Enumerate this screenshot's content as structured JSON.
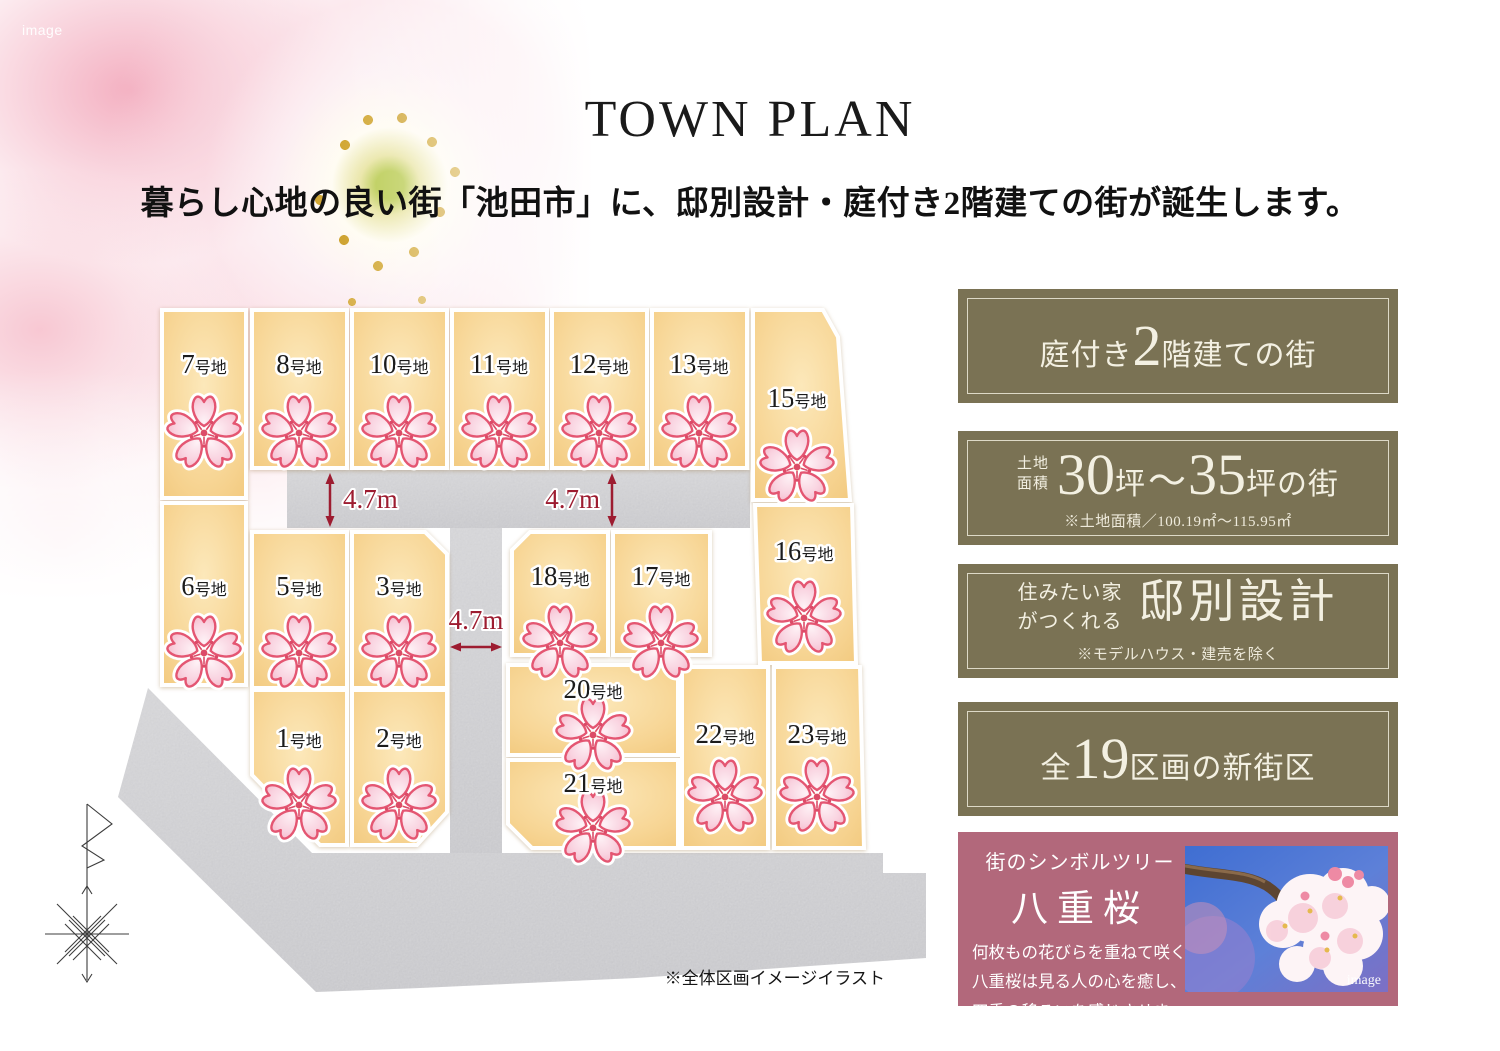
{
  "hero": {
    "image_label": "image"
  },
  "header": {
    "title": "TOWN PLAN",
    "subtitle": "暮らし心地の良い街「池田市」に、邸別設計・庭付き2階建ての街が誕生します。"
  },
  "map": {
    "note": "※全体区画イメージイラスト",
    "lot_suffix": "号地",
    "road_labels": [
      "4.7m",
      "4.7m",
      "4.7m"
    ],
    "lots": [
      {
        "number": "7"
      },
      {
        "number": "8"
      },
      {
        "number": "10"
      },
      {
        "number": "11"
      },
      {
        "number": "12"
      },
      {
        "number": "13"
      },
      {
        "number": "15"
      },
      {
        "number": "6"
      },
      {
        "number": "5"
      },
      {
        "number": "3"
      },
      {
        "number": "18"
      },
      {
        "number": "17"
      },
      {
        "number": "16"
      },
      {
        "number": "1"
      },
      {
        "number": "2"
      },
      {
        "number": "20"
      },
      {
        "number": "21"
      },
      {
        "number": "22"
      },
      {
        "number": "23"
      }
    ]
  },
  "panels": {
    "two_story": {
      "pre": "庭付き",
      "big": "2",
      "post": "階建ての街"
    },
    "land_area": {
      "stack_top": "土地",
      "stack_bottom": "面積",
      "big1": "30",
      "unit1": "坪",
      "tilde": "〜",
      "big2": "35",
      "unit2": "坪の街",
      "note": "※土地面積／100.19㎡〜115.95㎡"
    },
    "custom_design": {
      "stack_top": "住みたい家",
      "stack_bottom": "がつくれる",
      "big": "邸別設計",
      "note": "※モデルハウス・建売を除く"
    },
    "blocks": {
      "pre": "全",
      "big": "19",
      "post": "区画の新街区"
    }
  },
  "symbol_tree": {
    "heading": "街のシンボルツリー",
    "name": "八重桜",
    "lines": [
      "何枚もの花びらを重ねて咲く",
      "八重桜は見る人の心を癒し、",
      "四季の移ろいを感じさせます。"
    ],
    "image_label": "image"
  },
  "colors": {
    "panel_olive": "#7a7254",
    "panel_rose": "#b2687b",
    "lot_fill": "#f6d28e",
    "road_gray": "#c7c7ca",
    "dimension_red": "#9d1c30"
  }
}
